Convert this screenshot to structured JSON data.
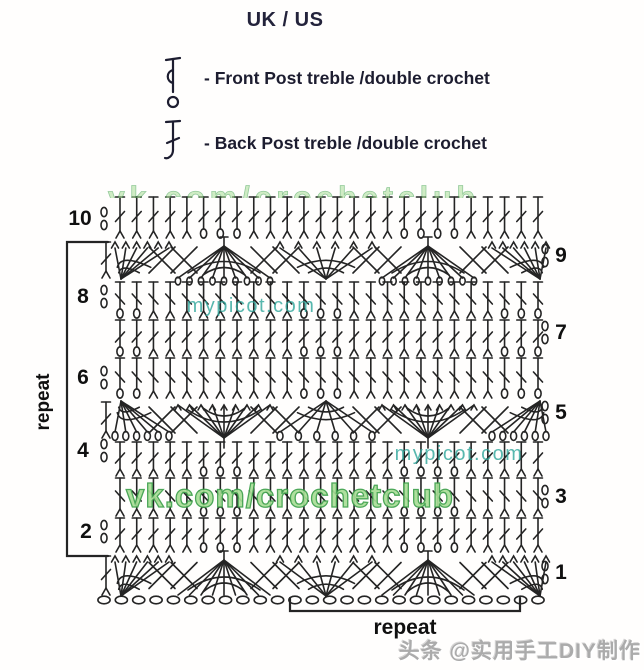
{
  "header": {
    "title": "UK / US",
    "legend": [
      {
        "icon": "front-post-treble-icon",
        "label": "-  Front Post treble /double crochet"
      },
      {
        "icon": "back-post-treble-icon",
        "label": "-  Back Post treble /double crochet"
      }
    ]
  },
  "diagram": {
    "left_row_numbers": [
      "10",
      "8",
      "6",
      "4",
      "2"
    ],
    "right_row_numbers": [
      "9",
      "7",
      "5",
      "3",
      "1"
    ],
    "side_repeat_label": "repeat",
    "bottom_repeat_label": "repeat"
  },
  "watermarks": {
    "top_clipped": "vk.com/crochetclub",
    "mypicot_upper": "mypicot.com",
    "mypicot_lower": "mypicot.com",
    "vk_club": "vk.com/crochetclub",
    "byline": "头条 @实用手工DIY制作"
  },
  "colors": {
    "stitch": "#242424",
    "heading_text": "#23233b",
    "row_number_text": "#101010",
    "watermark_teal": "#2fa69b",
    "watermark_green_fill": "#a9de97",
    "watermark_green_stroke": "#3da04b",
    "byline_gray": "#ababab"
  }
}
